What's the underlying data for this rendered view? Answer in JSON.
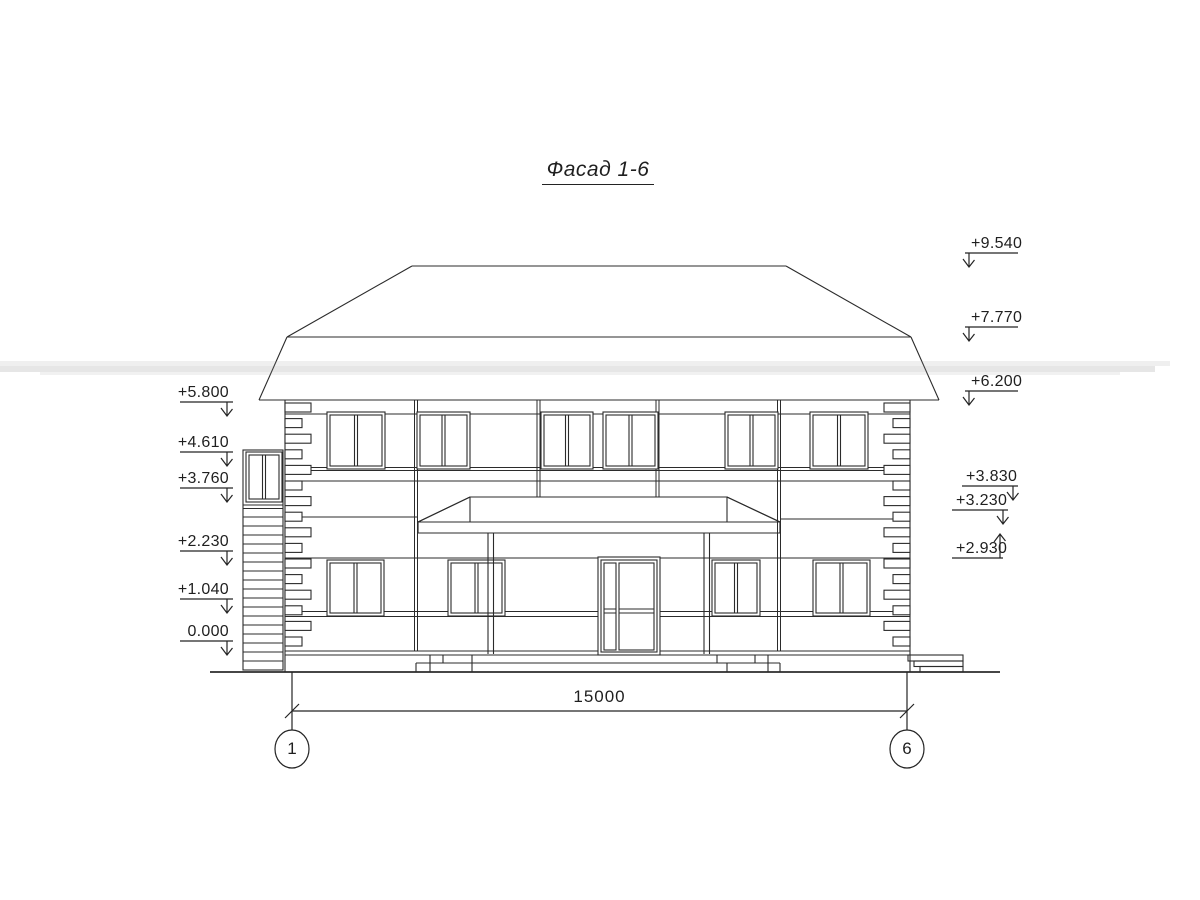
{
  "drawing": {
    "title": "Фасад 1-6",
    "dimension_label": "15000",
    "axis_left": "1",
    "axis_right": "6",
    "elevation_marks_left": [
      {
        "value": "+5.800"
      },
      {
        "value": "+4.610"
      },
      {
        "value": "+3.760"
      },
      {
        "value": "+2.230"
      },
      {
        "value": "+1.040"
      },
      {
        "value": "0.000"
      }
    ],
    "elevation_marks_right": [
      {
        "value": "+9.540"
      },
      {
        "value": "+7.770"
      },
      {
        "value": "+6.200"
      },
      {
        "value": "+3.830"
      },
      {
        "value": "+3.230"
      },
      {
        "value": "+2.930"
      }
    ],
    "ink_color": "#2b2b2b",
    "paper_color": "#ffffff"
  }
}
